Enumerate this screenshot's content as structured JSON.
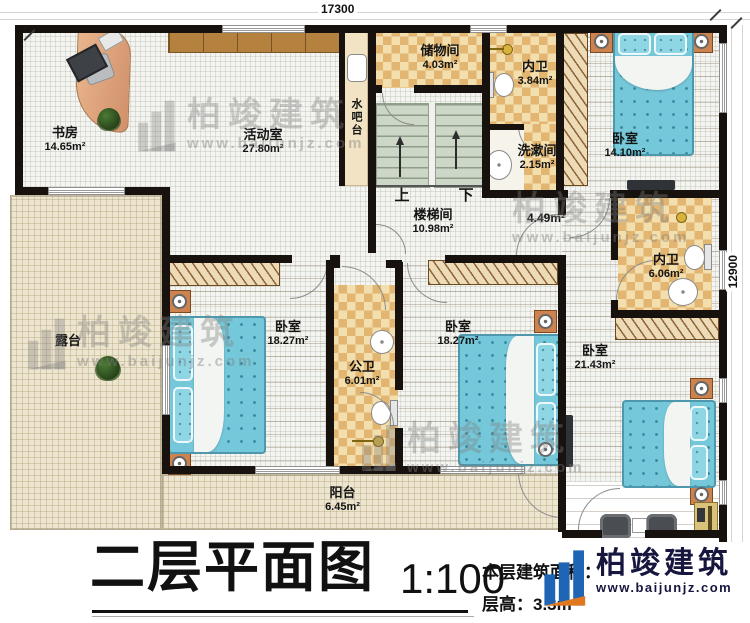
{
  "plan": {
    "title": "二层平面图",
    "scale": "1:100",
    "info_line1": "本层建筑面积：",
    "info_line2": "层高：3.3m",
    "dim_top": "17300",
    "dim_right": "12900",
    "corridor_area": "4.49m²",
    "stairs_up": "上",
    "stairs_down": "下"
  },
  "rooms": {
    "study": {
      "name": "书房",
      "area": "14.65m²"
    },
    "activity": {
      "name": "活动室",
      "area": "27.80m²"
    },
    "water_bar": {
      "name": "水吧台"
    },
    "storage": {
      "name": "储物间",
      "area": "4.03m²"
    },
    "bath_top": {
      "name": "内卫",
      "area": "3.84m²"
    },
    "washroom": {
      "name": "洗漱间",
      "area": "2.15m²"
    },
    "bedroom_tr": {
      "name": "卧室",
      "area": "14.10m²"
    },
    "stairwell": {
      "name": "楼梯间",
      "area": "10.98m²"
    },
    "bath_right": {
      "name": "内卫",
      "area": "6.06m²"
    },
    "terrace": {
      "name": "露台"
    },
    "bedroom_left": {
      "name": "卧室",
      "area": "18.27m²"
    },
    "public_bath": {
      "name": "公卫",
      "area": "6.01m²"
    },
    "bedroom_mid": {
      "name": "卧室",
      "area": "18.27m²"
    },
    "bedroom_br": {
      "name": "卧室",
      "area": "21.43m²"
    },
    "balcony": {
      "name": "阳台",
      "area": "6.45m²"
    }
  },
  "logo": {
    "name": "柏竣建筑",
    "website": "www.baijunjz.com"
  },
  "watermark": {
    "name": "柏竣建筑",
    "website": "www.baijunjz.com"
  },
  "colors": {
    "wall": "#17120e",
    "wood": "#b0793c",
    "tile_light": "#f3dfae",
    "tile_dark": "#e2b671",
    "bed": "#74c8da",
    "terrace": "#ede5cf",
    "stairs": "#ccd7c7",
    "accent_orange": "#cd8350",
    "logo_blue": "#1e66b5"
  }
}
